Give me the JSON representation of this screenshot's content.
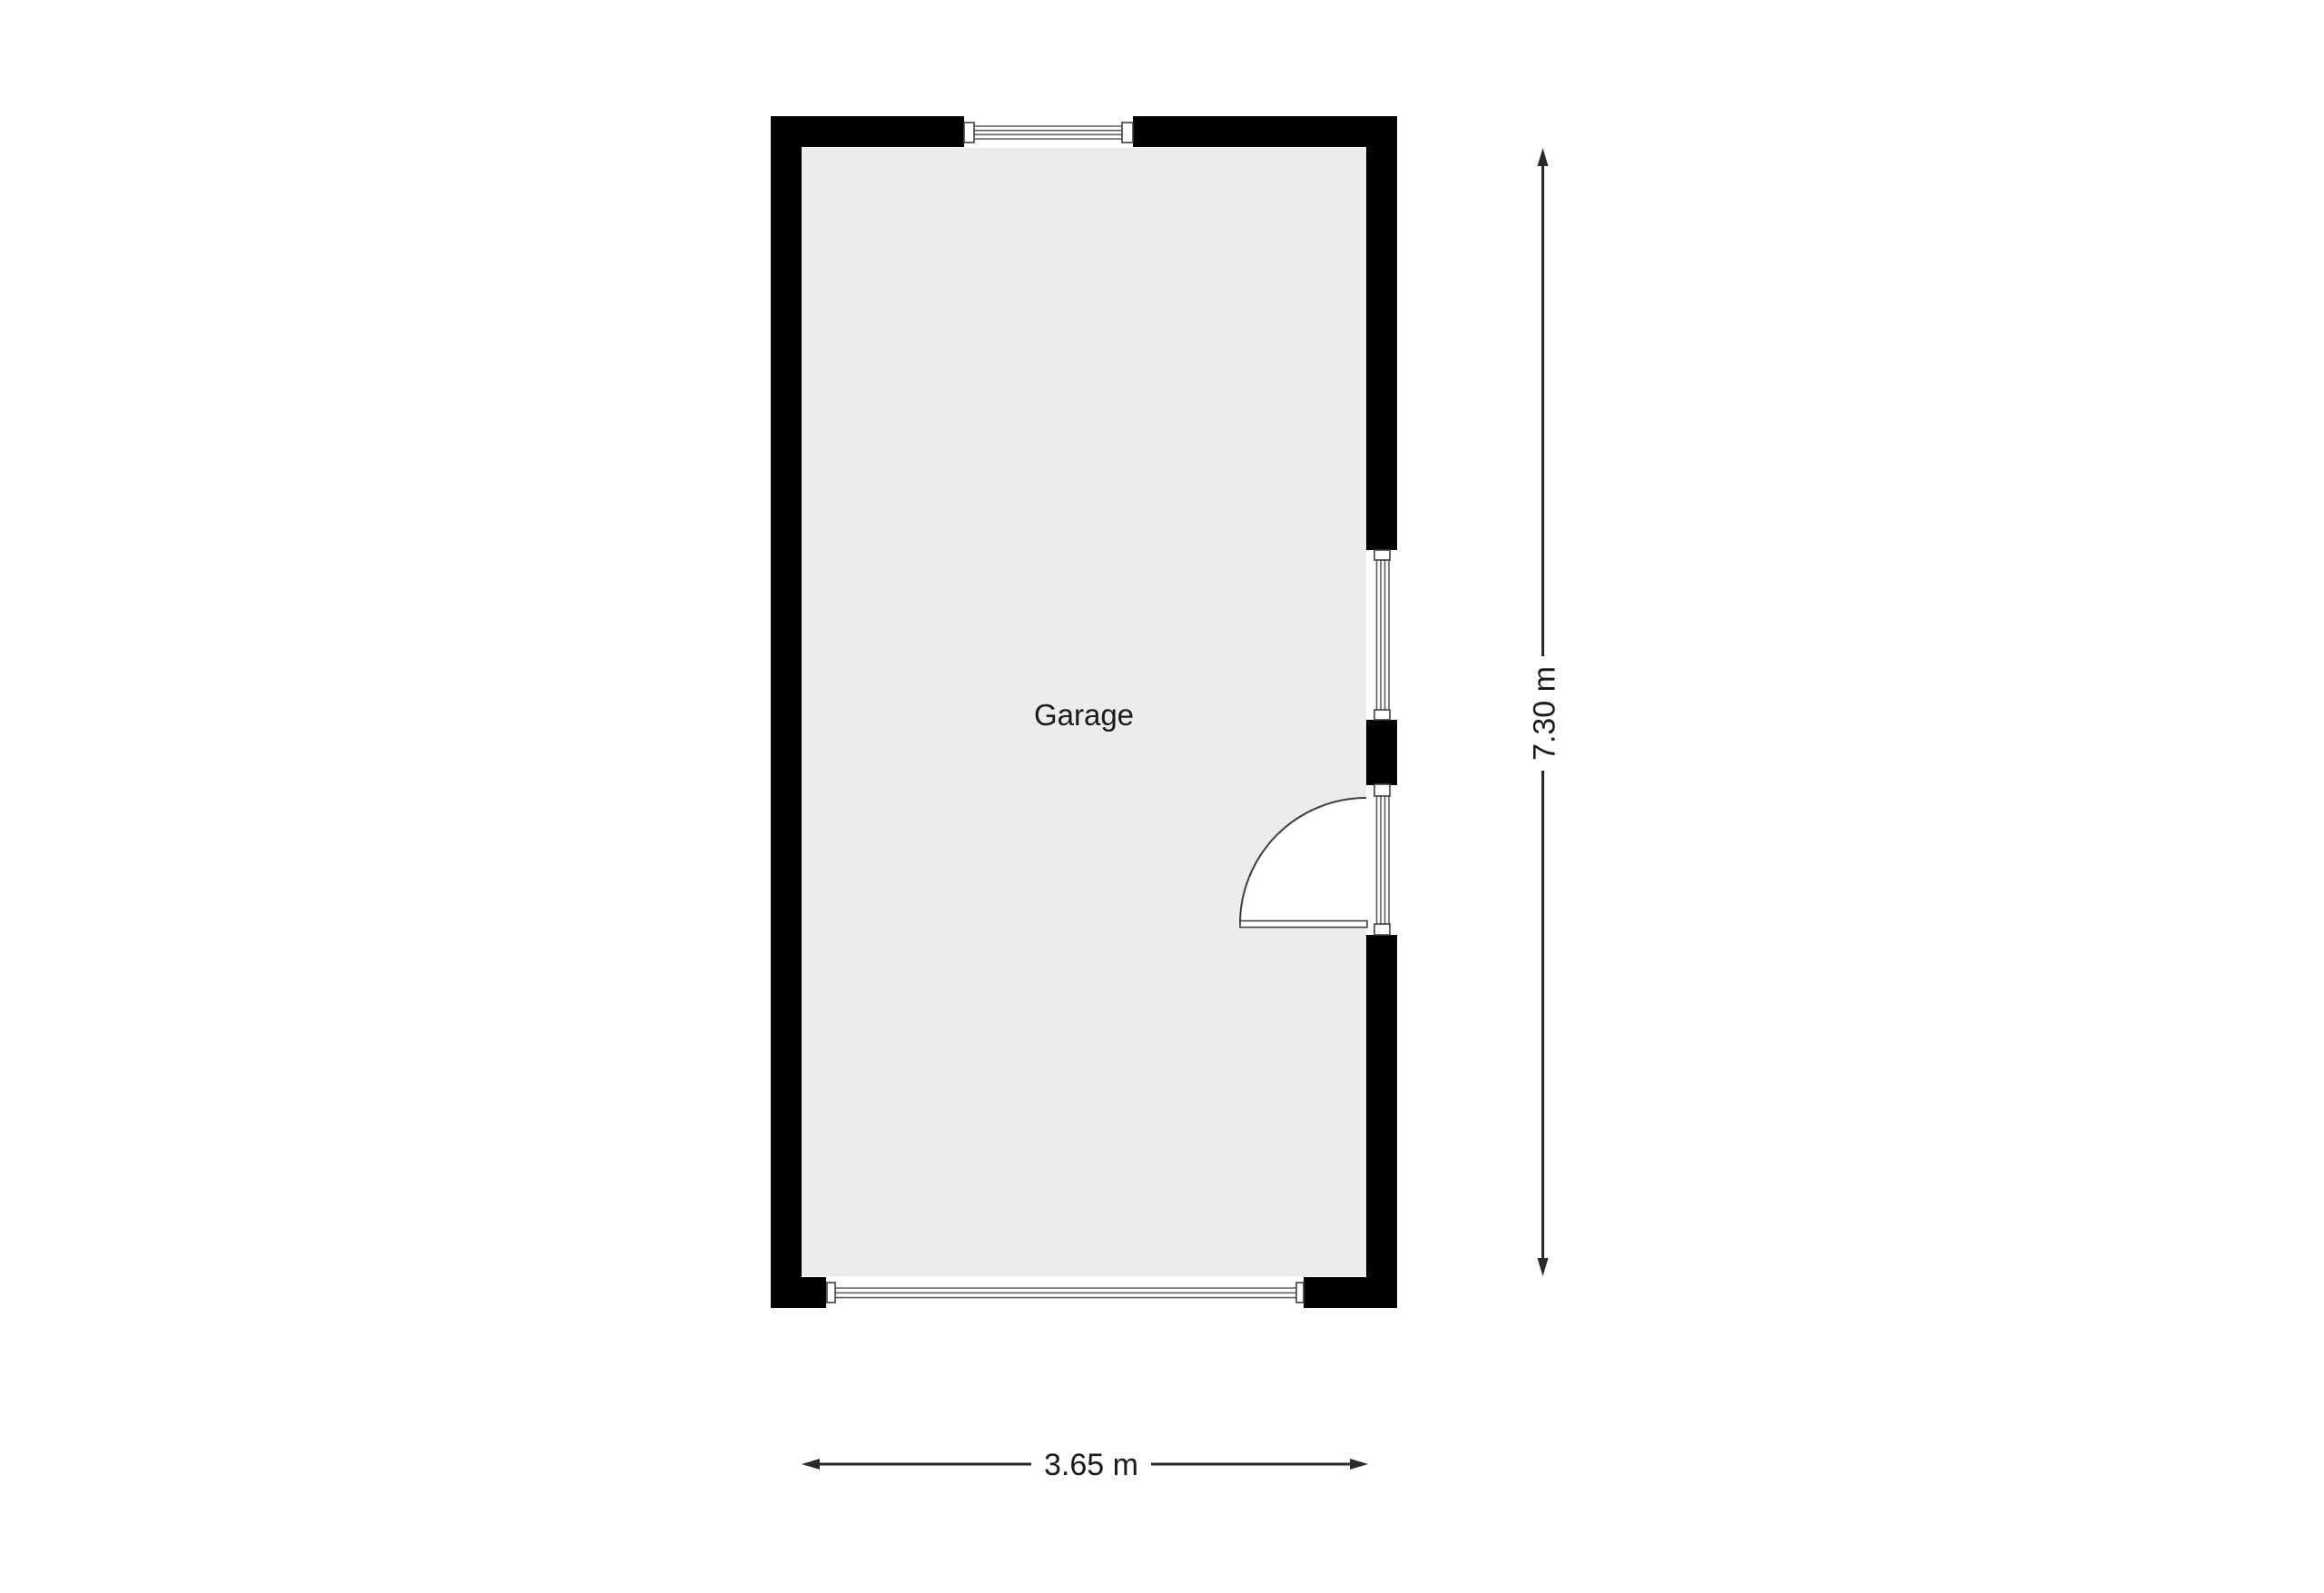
{
  "plan": {
    "room_label": "Garage",
    "dimensions": {
      "width_label": "3.65 m",
      "height_label": "7.30 m"
    }
  },
  "colors": {
    "background": "#ffffff",
    "wall": "#000000",
    "floor": "#ececec",
    "frame-line": "#3f3f3f",
    "glazing-line": "#5f5f5f",
    "dimension-line": "#2a2a2a",
    "text": "#1a1a1a"
  }
}
